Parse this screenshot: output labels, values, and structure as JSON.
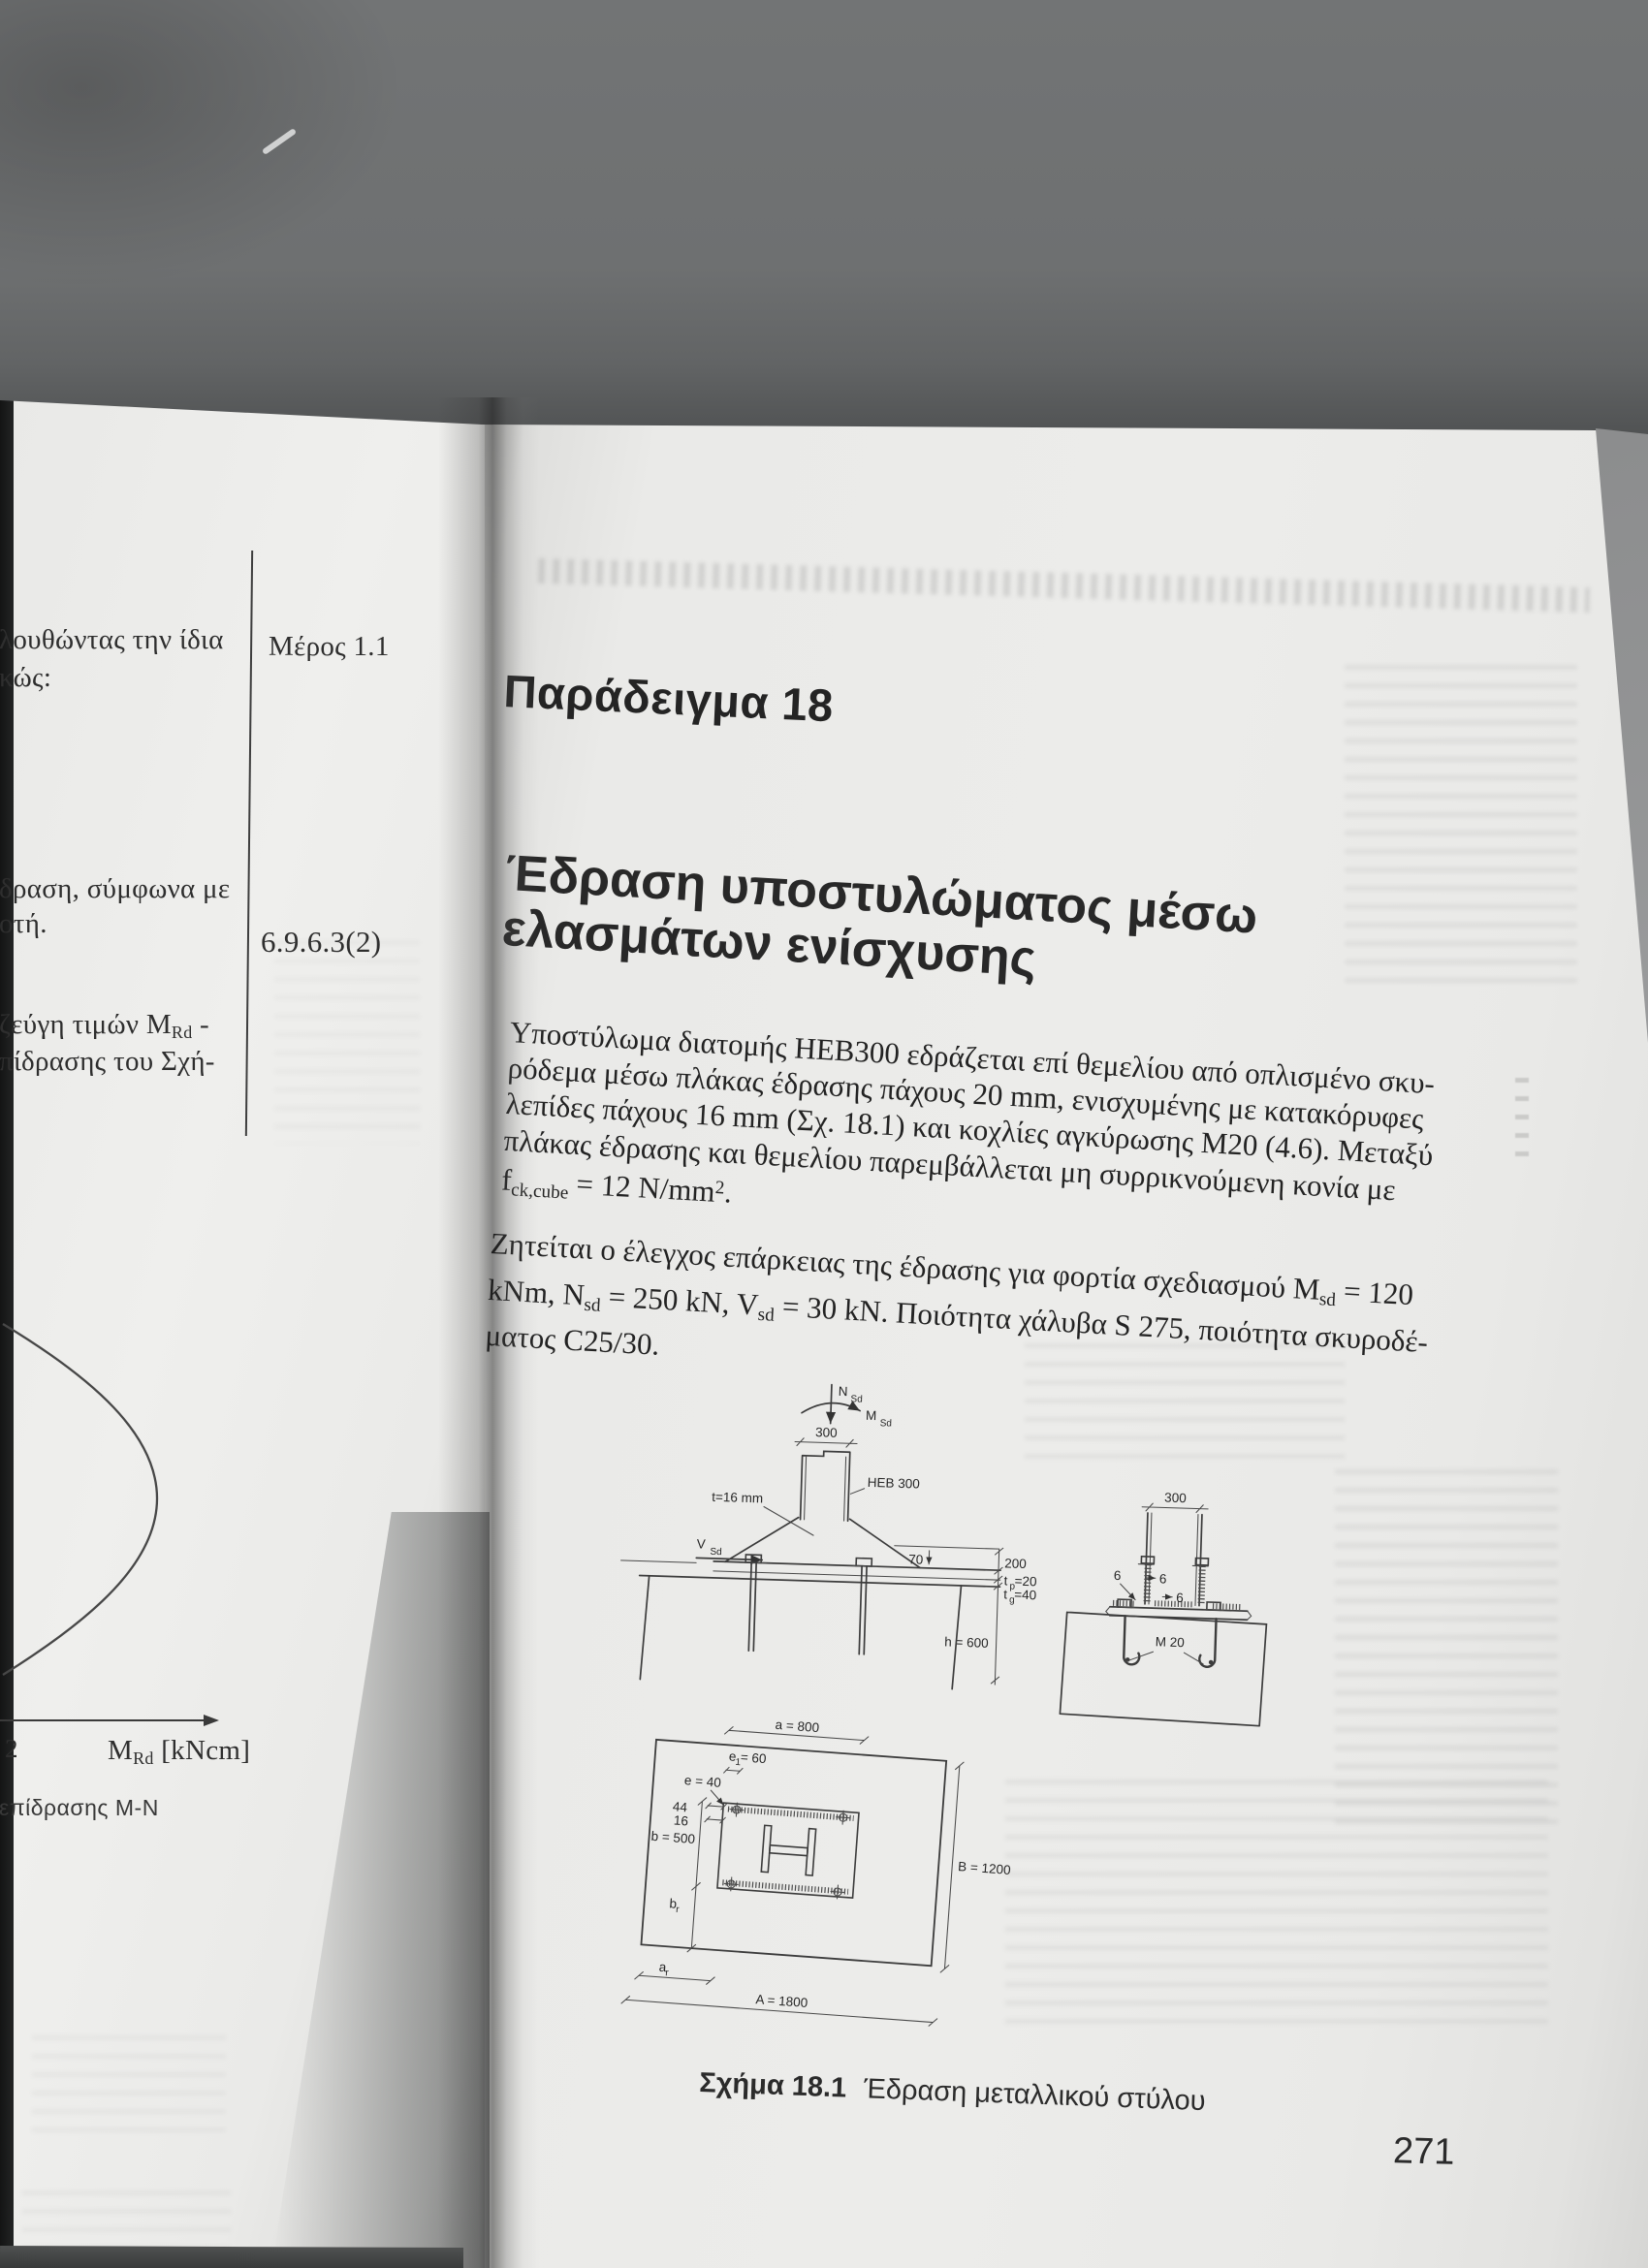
{
  "left_page": {
    "line1": "λουθώντας την ίδια",
    "line2": "κώς:",
    "note_part": "Μέρος 1.1",
    "line3": "δραση, σύμφωνα με",
    "line4": "οτή.",
    "note_clause": "6.9.6.3(2)",
    "line5_pre": "ζεύγη τιμών M",
    "line5_sub": "Rd",
    "line5_post": " -",
    "line6": "πίδρασης του Σχή-",
    "axis_tick": "2",
    "axis_m": "M",
    "axis_m_sub": "Rd",
    "axis_unit": " [kNcm]",
    "diagram_caption": "επίδρασης M-N"
  },
  "right_page": {
    "title": "Παράδειγμα 18",
    "heading1": "Έδραση υποστυλώματος μέσω",
    "heading2": "ελασμάτων ενίσχυσης",
    "para1": {
      "l1": "Υποστύλωμα διατομής HEB300 εδράζεται επί θεμελίου από οπλισμένο σκυ-",
      "l2": "ρόδεμα μέσω πλάκας έδρασης πάχους 20 mm, ενισχυμένης με κατακόρυφες",
      "l3": "λεπίδες πάχους 16 mm (Σχ. 18.1) και κοχλίες αγκύρωσης M20 (4.6). Μεταξύ",
      "l4": "πλάκας έδρασης και θεμελίου παρεμβάλλεται μη συρρικνούμενη κονία με",
      "l5_f": "f",
      "l5_fsub": "ck,cube",
      "l5_mid": " = 12 N/mm",
      "l5_sup": "2",
      "l5_end": "."
    },
    "para2": {
      "l1_pre": "Ζητείται ο έλεγχος επάρκειας της έδρασης για φορτία σχεδιασμού M",
      "l1_sub": "sd",
      "l1_post": " = 120",
      "l2_p1": "kNm, N",
      "l2_s1": "sd",
      "l2_p2": " = 250 kN, V",
      "l2_s2": "sd",
      "l2_p3": " = 30 kN. Ποιότητα χάλυβα S 275, ποιότητα σκυροδέ-",
      "l3": "ματος C25/30."
    },
    "caption_label": "Σχήμα 18.1",
    "caption_text": "Έδραση μεταλλικού στύλου",
    "page_number": "271"
  },
  "figure": {
    "n": "N",
    "n_sub": "Sd",
    "m": "M",
    "m_sub": "Sd",
    "v": "V",
    "v_sub": "Sd",
    "dim_300": "300",
    "heb": "HEB 300",
    "t16": "t=16 mm",
    "dim_70": "70",
    "dim_200": "200",
    "tp": "t",
    "tp_sub": "p",
    "tp_val": " =20",
    "tg": "t",
    "tg_sub": "g",
    "tg_val": " =40",
    "h600": "h = 600",
    "weld6": "6",
    "m20": "M 20",
    "a800": "a = 800",
    "e1": "e",
    "e1_sub": "1",
    "e1_val": " = 60",
    "e40": "e = 40",
    "d44": "44",
    "d16": "16",
    "b500": "b = 500",
    "B1200": "B = 1200",
    "br": "b",
    "br_sub": "r",
    "ar": "a",
    "ar_sub": "r",
    "A1800": "A = 1800"
  }
}
